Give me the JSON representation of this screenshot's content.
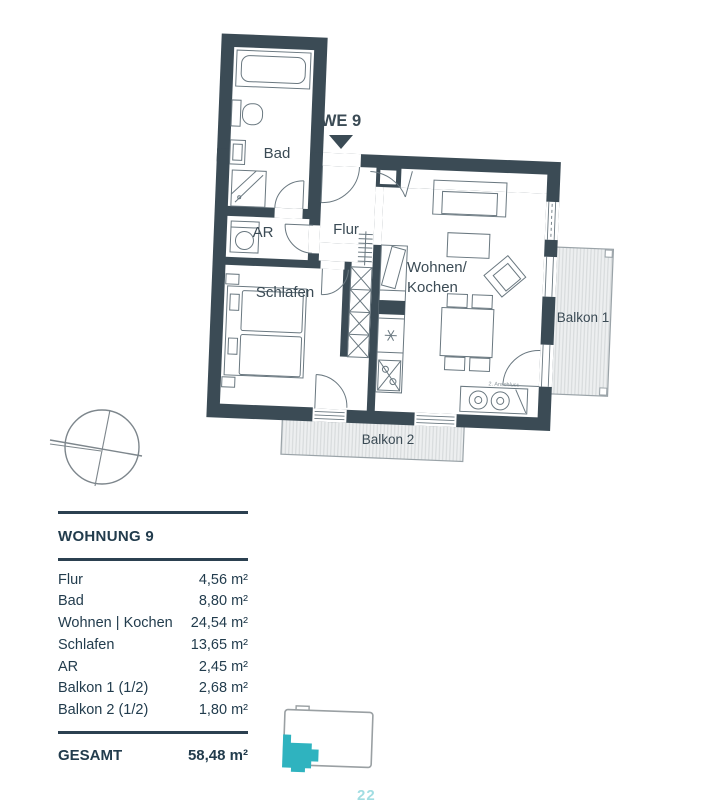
{
  "plan": {
    "unit_label": "WE 9",
    "rooms": {
      "bad": "Bad",
      "ar": "AR",
      "flur": "Flur",
      "schlafen": "Schlafen",
      "wohnen_line1": "Wohnen/",
      "wohnen_line2": "Kochen",
      "balkon1": "Balkon 1",
      "balkon2": "Balkon 2",
      "anschluss": "2. Anschluss"
    },
    "colors": {
      "wall": "#3b4b55",
      "furniture_stroke": "#6a7880",
      "balcony_fill": "#edeff0",
      "balcony_hatch": "#d3d7d9",
      "balcony_border": "#9aa3a8",
      "accent_teal": "#2fb3bf",
      "table_text": "#223c4d"
    }
  },
  "area_table": {
    "title": "WOHNUNG 9",
    "rows": [
      {
        "label": "Flur",
        "value": "4,56 m²"
      },
      {
        "label": "Bad",
        "value": "8,80 m²"
      },
      {
        "label": "Wohnen | Kochen",
        "value": "24,54 m²"
      },
      {
        "label": "Schlafen",
        "value": "13,65 m²"
      },
      {
        "label": "AR",
        "value": "2,45 m²"
      },
      {
        "label": "Balkon 1 (1/2)",
        "value": "2,68 m²"
      },
      {
        "label": "Balkon 2 (1/2)",
        "value": "1,80 m²"
      }
    ],
    "total": {
      "label": "GESAMT",
      "value": "58,48 m²"
    }
  },
  "page": {
    "page_number": "22"
  }
}
